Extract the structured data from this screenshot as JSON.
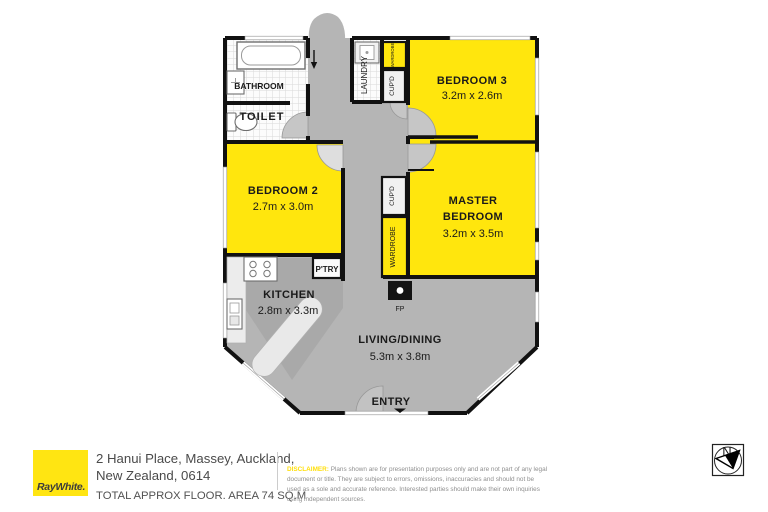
{
  "plan": {
    "rooms": {
      "bathroom": {
        "name": "BATHROOM"
      },
      "toilet": {
        "name": "TOILET"
      },
      "laundry": {
        "name": "LAUNDRY"
      },
      "cupboard": {
        "name": "CUP'D"
      },
      "wardrobe": {
        "name": "WARDROBE"
      },
      "bedroom3": {
        "name": "BEDROOM 3",
        "dims": "3.2m x 2.6m"
      },
      "bedroom2": {
        "name": "BEDROOM 2",
        "dims": "2.7m x 3.0m"
      },
      "master": {
        "name1": "MASTER",
        "name2": "BEDROOM",
        "dims": "3.2m x 3.5m"
      },
      "kitchen": {
        "name": "KITCHEN",
        "dims": "2.8m x 3.3m"
      },
      "pantry": {
        "name": "P'TRY"
      },
      "fireplace": {
        "name": "FP"
      },
      "living": {
        "name": "LIVING/DINING",
        "dims": "5.3m x 3.8m"
      },
      "entry": {
        "name": "ENTRY"
      }
    },
    "compass": {
      "north": "N"
    }
  },
  "footer": {
    "brand": "RayWhite.",
    "address_line1": "2 Hanui Place, Massey, Auckland,",
    "address_line2": "New Zealand, 0614",
    "area_text": "TOTAL APPROX FLOOR. AREA 74 SQ.M",
    "disclaimer_label": "DISCLAIMER:",
    "disclaimer_body": "Plans shown are for presentation purposes only and are not part of any legal document or title. They are subject to errors, omissions, inaccuracies and should not be used as a sole and accurate reference. Interested parties should make their own inquiries using independent sources."
  },
  "colors": {
    "room_highlight_yellow": "#ffe60d",
    "floor_gray": "#b5b5b5",
    "wall_black": "#111111",
    "brand_yellow": "#ffe512"
  }
}
